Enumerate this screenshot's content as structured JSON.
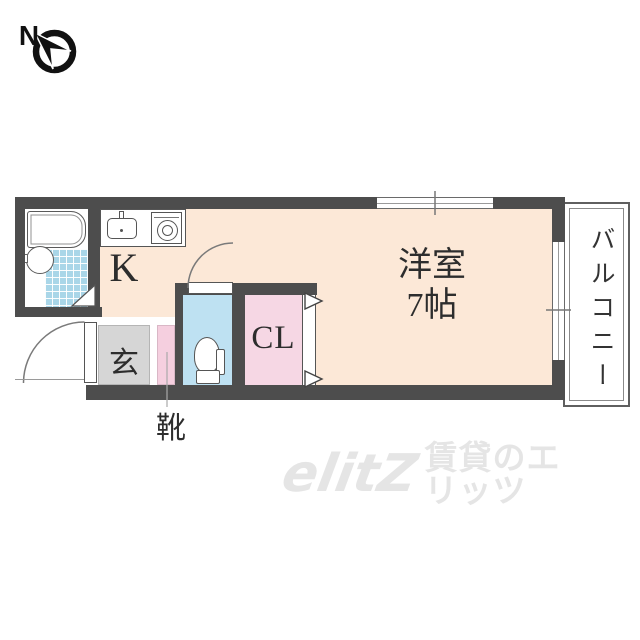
{
  "compass": {
    "label": "N"
  },
  "rooms": {
    "kitchen": {
      "label": "K"
    },
    "genkan": {
      "label": "玄"
    },
    "shoes": {
      "label": "靴"
    },
    "closet": {
      "label": "CL"
    },
    "western_room": {
      "label": "洋室",
      "size": "7帖"
    },
    "balcony": {
      "label": "バルコニー"
    }
  },
  "watermark": {
    "logo": "elitZ",
    "text": "賃貸のエリッツ"
  },
  "colors": {
    "wall": "#4d4d4d",
    "floor": "#fce8d7",
    "genkan": "#d6d6d6",
    "toilet": "#bee1f2",
    "closet": "#f6d7e4",
    "shoe_cabinet": "#f5cfdf",
    "tile": "#a9d6e8",
    "label_text": "#2d2d2d",
    "watermark": "#e5e5e5"
  }
}
